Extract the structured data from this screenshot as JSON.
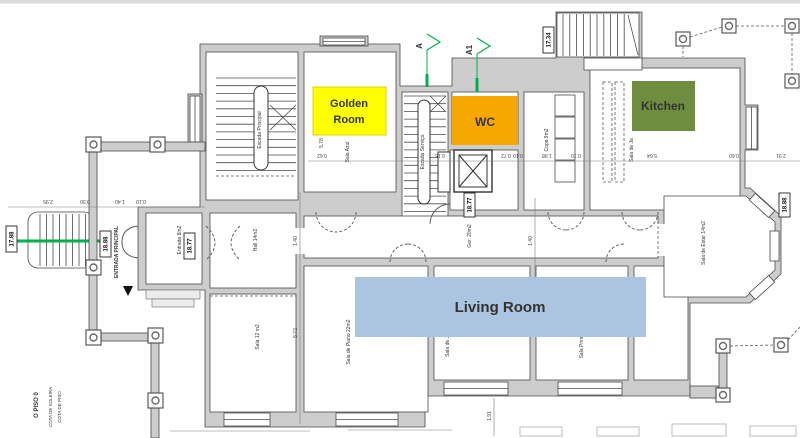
{
  "colors": {
    "wall_fill": "#cdcdcd",
    "line": "#4a4a4a",
    "golden_room_bg": "#ffff00",
    "wc_bg": "#f6a800",
    "kitchen_bg": "#6f8d3f",
    "living_room_bg": "#abc4df",
    "living_room_text": "#1f3a5f",
    "section_marker_green": "#00b050"
  },
  "overlays": {
    "golden_room_line1": "Golden",
    "golden_room_line2": "Room",
    "wc": "WC",
    "kitchen": "Kitchen",
    "living_room": "Living Room"
  },
  "section_markers": {
    "a": "A",
    "a1": "A1"
  },
  "levels": {
    "entry_stair": "17.88",
    "porch": "18.88",
    "entrada": "18.77",
    "elevator_hall": "18.77",
    "service_stair_top": "17.34",
    "east_terrace": "18.88"
  },
  "rooms": {
    "escada_principal": "Escada Principal",
    "escada_servico": "Escada Serviço",
    "sala_azul": "Sala Azul",
    "entrada": "Entrada 8m2",
    "hall": "Hall 14m2",
    "sala_12": "Sala 12 m2",
    "sala_piano": "Sala de Piano 22m2",
    "ger": "Ger. 20m2",
    "copa": "Copa 9m2",
    "sala_jantar_top": "Sala de Ja",
    "sala_jantar_bottom": "Sala de Ja",
    "sala_princ": "Sala Princ",
    "sala_estar": "Sala de Estar 14m2",
    "entrada_principal": "ENTRADA PRINCIPAL"
  },
  "dimensions": {
    "left": [
      "2.95",
      "0.30",
      "1.40",
      "0.10"
    ],
    "datum": [
      "0.62",
      "0.15",
      "0.72",
      "0.10",
      "1.98",
      "0.70",
      "5.64",
      "0.60",
      "2.91"
    ],
    "v1": "5.78",
    "v2": "1.40",
    "v3": "5.72",
    "v4": "1.40",
    "v5": "1.91"
  },
  "footer": {
    "line1": "O PISO 0",
    "line2": "COTA DE SOLEIRA",
    "line3": "COTA DE PISO"
  }
}
